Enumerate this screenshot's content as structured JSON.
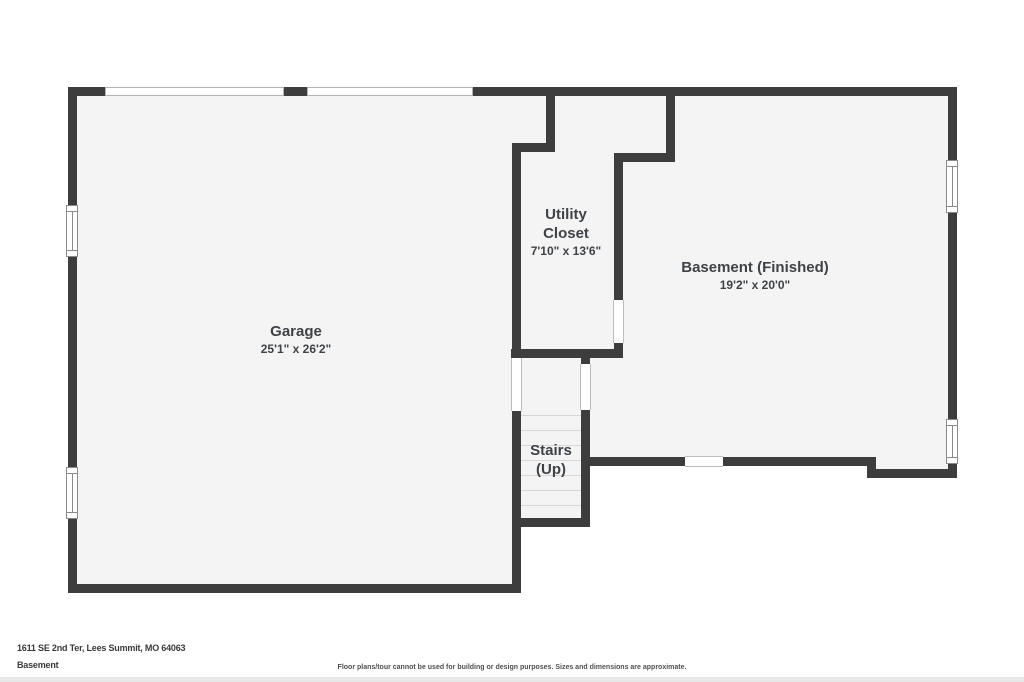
{
  "plan": {
    "rooms": {
      "garage": {
        "name": "Garage",
        "dims": "25'1\" x 26'2\""
      },
      "utility_closet": {
        "name_line1": "Utility",
        "name_line2": "Closet",
        "dims": "7'10\" x 13'6\""
      },
      "basement": {
        "name": "Basement (Finished)",
        "dims": "19'2\" x 20'0\""
      },
      "stairs": {
        "name_line1": "Stairs",
        "name_line2": "(Up)"
      }
    }
  },
  "footer": {
    "address": "1611 SE 2nd Ter, Lees Summit, MO 64063",
    "floor_label": "Basement",
    "disclaimer": "Floor plans/tour cannot be used for building or design purposes. Sizes and dimensions are approximate."
  },
  "colors": {
    "wall": "#3d3d3d",
    "floor": "#f4f4f4",
    "label_text": "#3f4246"
  }
}
